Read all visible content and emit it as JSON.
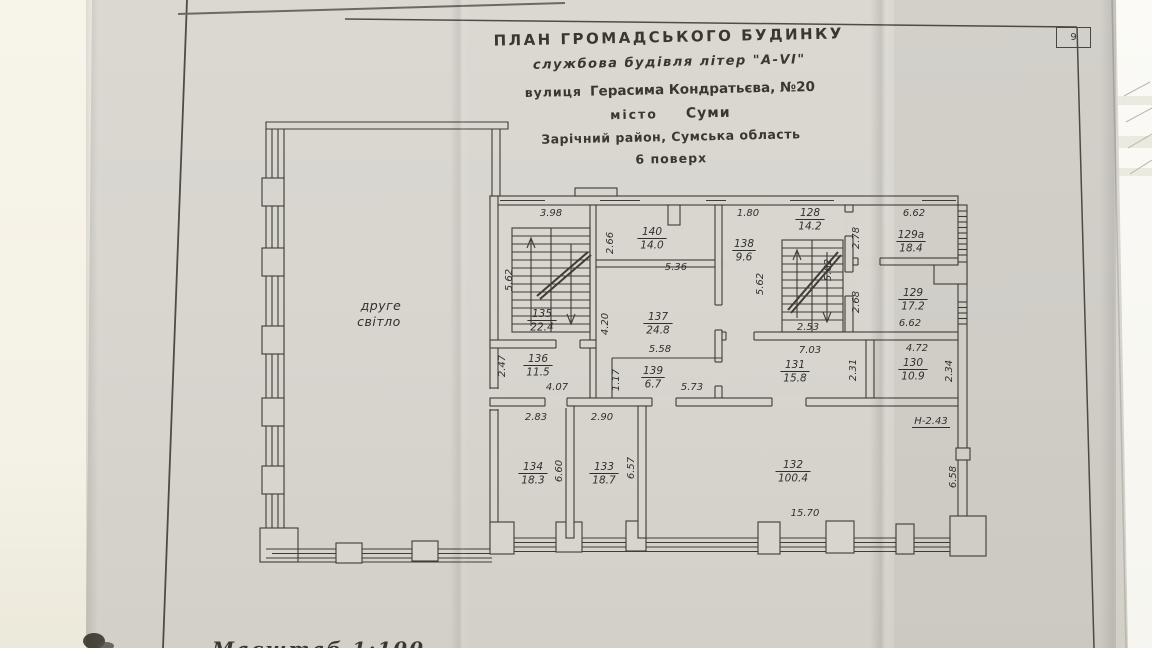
{
  "photo": {
    "paper_color": "#d7d5ce",
    "ink_color": "#3e3c34"
  },
  "page": {
    "sheet_number": "9",
    "scale_label": "Масштаб  1:100"
  },
  "title_block": {
    "line1": "ПЛАН  ГРОМАДСЬКОГО БУДИНКУ",
    "line2": "службова будівля літер \"А-VI\"",
    "street_label": "вулиця",
    "street_value": "Герасима Кондратьєва, №20",
    "city_label": "місто",
    "city_value": "Суми",
    "district": "Зарічний район, Сумська область",
    "floor": "6 поверх"
  },
  "plan": {
    "void_line1": "друге",
    "void_line2": "світло",
    "height_note": {
      "v": "Н-2.43",
      "x": 931,
      "y": 424
    },
    "rooms": [
      {
        "n": "135",
        "a": "22.4",
        "x": 542,
        "y": 317
      },
      {
        "n": "136",
        "a": "11.5",
        "x": 538,
        "y": 362
      },
      {
        "n": "137",
        "a": "24.8",
        "x": 658,
        "y": 320
      },
      {
        "n": "138",
        "a": "9.6",
        "x": 744,
        "y": 247
      },
      {
        "n": "139",
        "a": "6.7",
        "x": 653,
        "y": 374
      },
      {
        "n": "140",
        "a": "14.0",
        "x": 652,
        "y": 235
      },
      {
        "n": "128",
        "a": "14.2",
        "x": 810,
        "y": 216
      },
      {
        "n": "129а",
        "a": "18.4",
        "x": 911,
        "y": 238
      },
      {
        "n": "129",
        "a": "17.2",
        "x": 913,
        "y": 296
      },
      {
        "n": "130",
        "a": "10.9",
        "x": 913,
        "y": 366
      },
      {
        "n": "131",
        "a": "15.8",
        "x": 795,
        "y": 368
      },
      {
        "n": "132",
        "a": "100.4",
        "x": 793,
        "y": 468
      },
      {
        "n": "133",
        "a": "18.7",
        "x": 604,
        "y": 470
      },
      {
        "n": "134",
        "a": "18.3",
        "x": 533,
        "y": 470
      }
    ],
    "dims": [
      {
        "v": "3.98",
        "x": 551,
        "y": 216,
        "r": 0
      },
      {
        "v": "5.62",
        "x": 512,
        "y": 280,
        "r": 90
      },
      {
        "v": "2.66",
        "x": 613,
        "y": 243,
        "r": 90
      },
      {
        "v": "5.36",
        "x": 676,
        "y": 270,
        "r": 0
      },
      {
        "v": "1.80",
        "x": 748,
        "y": 216,
        "r": 0
      },
      {
        "v": "5.62",
        "x": 763,
        "y": 284,
        "r": 90
      },
      {
        "v": "5.62",
        "x": 831,
        "y": 270,
        "r": 90
      },
      {
        "v": "2.53",
        "x": 808,
        "y": 330,
        "r": 0
      },
      {
        "v": "2.78",
        "x": 859,
        "y": 238,
        "r": 90
      },
      {
        "v": "6.62",
        "x": 914,
        "y": 216,
        "r": 0
      },
      {
        "v": "2.68",
        "x": 859,
        "y": 302,
        "r": 90
      },
      {
        "v": "6.62",
        "x": 910,
        "y": 326,
        "r": 0
      },
      {
        "v": "4.20",
        "x": 608,
        "y": 324,
        "r": 90
      },
      {
        "v": "5.58",
        "x": 660,
        "y": 352,
        "r": 0
      },
      {
        "v": "1.17",
        "x": 619,
        "y": 380,
        "r": 90
      },
      {
        "v": "5.73",
        "x": 692,
        "y": 390,
        "r": 0
      },
      {
        "v": "2.47",
        "x": 505,
        "y": 366,
        "r": 90
      },
      {
        "v": "4.07",
        "x": 557,
        "y": 390,
        "r": 0
      },
      {
        "v": "7.03",
        "x": 810,
        "y": 353,
        "r": 0
      },
      {
        "v": "2.31",
        "x": 856,
        "y": 370,
        "r": 90
      },
      {
        "v": "4.72",
        "x": 917,
        "y": 351,
        "r": 0
      },
      {
        "v": "2.34",
        "x": 952,
        "y": 371,
        "r": 90
      },
      {
        "v": "2.83",
        "x": 536,
        "y": 420,
        "r": 0
      },
      {
        "v": "2.90",
        "x": 602,
        "y": 420,
        "r": 0
      },
      {
        "v": "6.60",
        "x": 562,
        "y": 471,
        "r": 90
      },
      {
        "v": "6.57",
        "x": 634,
        "y": 468,
        "r": 90
      },
      {
        "v": "15.70",
        "x": 805,
        "y": 516,
        "r": 0
      },
      {
        "v": "6.58",
        "x": 956,
        "y": 477,
        "r": 90
      }
    ]
  }
}
